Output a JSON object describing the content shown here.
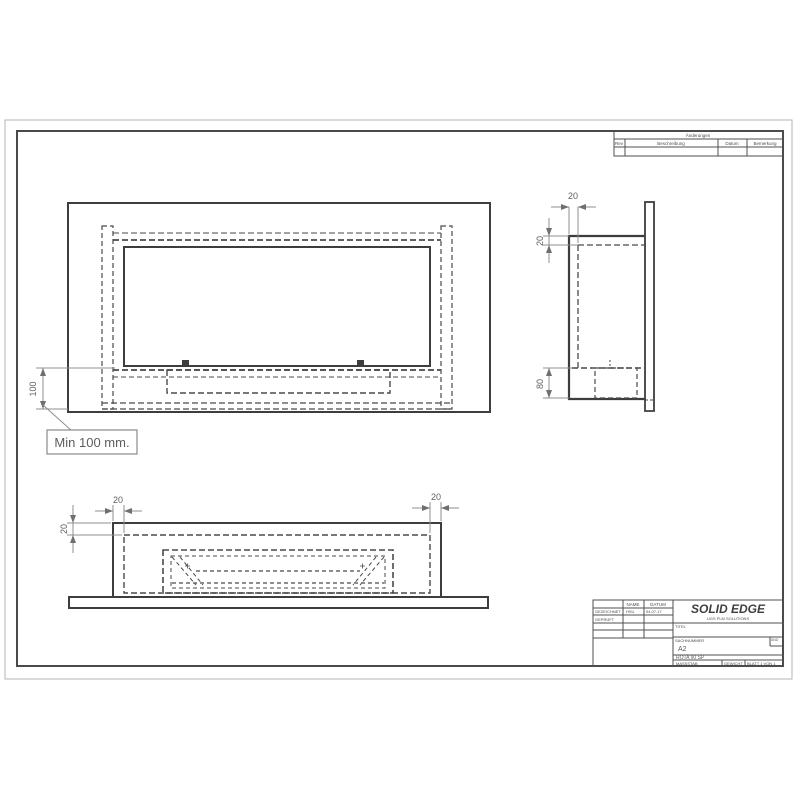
{
  "dimensions": {
    "front_height": "100",
    "front_callout": "Min 100 mm.",
    "side_top": "20",
    "side_left": "20",
    "side_bottom": "80",
    "bottom_left_top": "20",
    "bottom_right_top": "20",
    "bottom_left_side": "20"
  },
  "revision_table": {
    "title": "Änderungen",
    "columns": {
      "rev": "Rev",
      "description": "Beschreibung",
      "date": "Datum",
      "note": "Bemerkung"
    }
  },
  "title_block": {
    "brand": "SOLID EDGE",
    "brand_sub": "UGS PLM SOLUTIONS",
    "col_name": "NAME",
    "col_date": "DATUM",
    "row_drawn_label": "GEZEICHNET",
    "row_drawn_name": "HSU",
    "row_drawn_date": "04.07.17",
    "row_checked_label": "GEPRÜFT",
    "title_label": "TITEL",
    "partno_label": "SACHNUMMER",
    "partno_value": "A2",
    "rev_label": "ÄND",
    "doc_name": "ROTA 90 SP",
    "scale_label": "MASSSTAB",
    "weight_label": "GEWICHT",
    "sheet_label": "BLATT 1 VON 1"
  },
  "colors": {
    "object_line": "#3d3d3d",
    "hidden_line": "#4a4a4a",
    "dimension_line": "#8f8f8f",
    "sheet_edge": "#b5b5b5",
    "inner_border": "#4a4a4a"
  }
}
